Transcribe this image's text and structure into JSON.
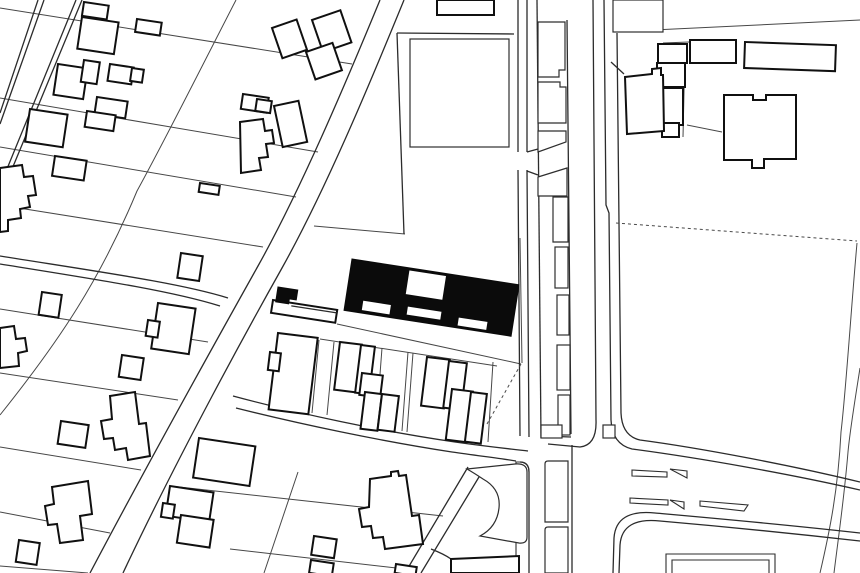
{
  "meta": {
    "description": "Black-and-white architectural figure-ground site plan with solid black building footprint at center"
  },
  "map": {
    "width": 860,
    "height": 573,
    "background": "#ffffff",
    "styles": {
      "parcel": {
        "stroke": "#474747",
        "width": 1,
        "fill": "none"
      },
      "road": {
        "stroke": "#2b2b2b",
        "width": 1.3,
        "fill": "none"
      },
      "lightline": {
        "stroke": "#2e2e2e",
        "width": 1.1,
        "fill": "none"
      },
      "light": {
        "stroke": "#2e2e2e",
        "width": 1.2,
        "fill": "#ffffff"
      },
      "building": {
        "stroke": "#101010",
        "width": 2,
        "fill": "#ffffff"
      },
      "solid": {
        "stroke": "#0b0b0b",
        "width": 1,
        "fill": "#0b0b0b"
      },
      "dashed": {
        "stroke": "#4a4a4a",
        "width": 1,
        "fill": "none",
        "dash": "3,3"
      }
    },
    "layers": [
      {
        "name": "parcel-lines",
        "style": "parcel",
        "paths": [
          "M0,8 L352,64",
          "M0,98 L318,152",
          "M0,147 L296,197",
          "M0,205 L263,247",
          "M0,309 L208,342",
          "M0,373 L178,400",
          "M0,447 L141,470",
          "M0,512 L110,533",
          "M0,566 L88,573",
          "M236,0 C200,70 165,140 137,191 C100,280 60,340 0,415",
          "M314,226 L405,234",
          "M520,238 L522,363",
          "M337,324 L521,364",
          "M320,339 L497,366",
          "M319,340 L312,413",
          "M334,342 L327,415",
          "M382,348 L376,427",
          "M408,352 L402,431",
          "M413,353 L407,432",
          "M493,362 L488,442",
          "M298,472 L264,573",
          "M170,486 L443,516",
          "M230,549 L414,570",
          "M685,45 L683,137",
          "M687,125 L722,132",
          "M663,43 L689,42",
          "M613,32 L860,20",
          "M857,243 C851,310 846,390 841,432 C838,490 830,530 820,573",
          "M860,368 C855,400 850,430 848,452 C844,500 838,540 834,573"
        ]
      },
      {
        "name": "road-lines",
        "style": "road",
        "paths": [
          "M380,0 C345,85 300,191 258,266 C225,325 155,450 90,573",
          "M404,0 C368,88 325,191 282,268 C250,325 180,452 123,573",
          "M38,0 L0,113",
          "M44,0 L0,124",
          "M76,0 L0,186",
          "M82,0 L0,198",
          "M0,256 C100,272 180,283 228,298",
          "M0,264 C100,280 172,291 220,306",
          "M518,0 L518,152 M518,170 L520,436",
          "M527,0 L527,152 M527,170 L529,437",
          "M537,0 L541,438",
          "M567,20 L571,434 M541,436 L571,437",
          "M527,152 L538,149 M527,171 L538,175",
          "M593,0 L596,420 Q597,445 580,447 L548,444",
          "M604,0 L606,205 L609,213 L611,420 Q612,444 632,449 C700,458 790,474 860,490",
          "M617,33 L621,413 Q622,436 640,440 C700,448 790,465 860,482",
          "M611,62 L624,74",
          "M860,533 C780,524 700,517 655,513 Q616,509 614,538 L613,573",
          "M860,541 C780,532 706,525 660,521 Q622,517 620,545 L619,573",
          "M233,396 C300,414 380,431 455,442 C490,447 512,449 528,451",
          "M236,408 C300,424 380,441 452,452 C480,456 505,459 516,461",
          "M520,462 Q529,462 529,472 L529,573",
          "M572,445 L572,573",
          "M397,33 L404,234",
          "M397,33 L514,34",
          "M468,467 L405,573",
          "M482,472 L421,573",
          "M431,549 Q444,554 451,559"
        ]
      },
      {
        "name": "light-open-lines",
        "style": "lightline",
        "paths": [
          "M516,573 L516,462 L519,462 Q529,462 529,472",
          "M666,573 L666,554 L775,554 L775,573",
          "M672,573 L672,560 L769,560 L769,573",
          "M632,470 L667,472 L667,477 L632,476 Z",
          "M630,498 L668,500 L668,505 L630,503 Z",
          "M670,469 L687,471 L687,478 Z",
          "M670,500 L684,502 L684,509 Z",
          "M700,501 L748,505 L744,511 L700,506 Z",
          "M466,558 L466,573 M480,558 L480,573 M494,557 L494,573 M508,557 L508,573"
        ]
      },
      {
        "name": "light-structures",
        "style": "light",
        "rects": [
          [
            555,
            247,
            13,
            41,
            0
          ],
          [
            557,
            295,
            12,
            40,
            0
          ],
          [
            557,
            345,
            13,
            45,
            0
          ],
          [
            558,
            395,
            12,
            40,
            0
          ],
          [
            613,
            0,
            50,
            32,
            0
          ],
          [
            541,
            425,
            21,
            13,
            0
          ],
          [
            603,
            425,
            12,
            13,
            0
          ],
          [
            410,
            39,
            99,
            108,
            0
          ]
        ],
        "paths": [
          "M538,22 L565,22 L565,70 L559,70 L559,77 L538,77 Z",
          "M538,82 L560,82 L560,87 L566,87 L566,123 L538,123 Z",
          "M538,131 L566,131 L566,142 L538,152 Z",
          "M538,177 L567,168 L567,196 L538,196 Z",
          "M553,197 L568,197 L568,242 L553,242 Z",
          "M548,461 L568,461 L568,522 L545,522 L545,464 Q545,461 548,461 Z",
          "M548,527 L568,527 L568,573 L545,573 L545,530 Q545,527 548,527 Z",
          "M467,469 L515,464 Q527,463 527,472 L527,537 Q527,544 519,543 L480,536 Q497,527 499,508 Q501,489 483,479 Q474,473 467,469 Z"
        ]
      },
      {
        "name": "building-outlines",
        "style": "building",
        "rects": [
          [
            84,
            2,
            25,
            14,
            8.5
          ],
          [
            82,
            17,
            37,
            32,
            8.5
          ],
          [
            137,
            19,
            25,
            13,
            8.5
          ],
          [
            58,
            64,
            30,
            31,
            8.5
          ],
          [
            84,
            60,
            16,
            22,
            8.5
          ],
          [
            110,
            64,
            24,
            17,
            8.5
          ],
          [
            132,
            68,
            12,
            13,
            8.5
          ],
          [
            97,
            97,
            31,
            17,
            8.5
          ],
          [
            87,
            111,
            29,
            16,
            8.5
          ],
          [
            30,
            109,
            38,
            33,
            8.5
          ],
          [
            55,
            156,
            32,
            20,
            8.5
          ],
          [
            181,
            253,
            22,
            25,
            8.5
          ],
          [
            42,
            292,
            20,
            23,
            8.5
          ],
          [
            158,
            303,
            38,
            46,
            8.5
          ],
          [
            148,
            320,
            12,
            16,
            8.5
          ],
          [
            122,
            355,
            22,
            22,
            8.5
          ],
          [
            61,
            421,
            28,
            23,
            8.5
          ],
          [
            19,
            540,
            21,
            22,
            8.5
          ],
          [
            199,
            438,
            57,
            40,
            8.5
          ],
          [
            170,
            486,
            44,
            30,
            8.5
          ],
          [
            181,
            515,
            33,
            28,
            8.5
          ],
          [
            163,
            503,
            12,
            14,
            8.5
          ],
          [
            200,
            183,
            20,
            9,
            8.5
          ],
          [
            243,
            94,
            26,
            15,
            8.5
          ],
          [
            257,
            99,
            15,
            12,
            8.5
          ],
          [
            272,
            28,
            26,
            32,
            -19
          ],
          [
            312,
            20,
            30,
            34,
            -19
          ],
          [
            306,
            52,
            28,
            29,
            -19
          ],
          [
            274,
            106,
            25,
            42,
            -12
          ],
          [
            278,
            333,
            40,
            77,
            7
          ],
          [
            270,
            352,
            11,
            18,
            7
          ],
          [
            340,
            342,
            22,
            48,
            7
          ],
          [
            361,
            345,
            14,
            48,
            7
          ],
          [
            362,
            373,
            21,
            22,
            7
          ],
          [
            365,
            392,
            17,
            37,
            7
          ],
          [
            382,
            394,
            17,
            36,
            7
          ],
          [
            427,
            357,
            23,
            49,
            7
          ],
          [
            449,
            361,
            18,
            47,
            7
          ],
          [
            452,
            389,
            21,
            51,
            7
          ],
          [
            471,
            392,
            16,
            50,
            7
          ],
          [
            314,
            536,
            23,
            19,
            8.5
          ],
          [
            311,
            560,
            23,
            13,
            8.5
          ],
          [
            396,
            564,
            21,
            9,
            8.5
          ],
          [
            658,
            44,
            29,
            19,
            0
          ],
          [
            657,
            63,
            28,
            24,
            0
          ],
          [
            663,
            88,
            20,
            37,
            0
          ],
          [
            662,
            123,
            17,
            14,
            0
          ],
          [
            690,
            40,
            46,
            23,
            0
          ],
          [
            745,
            42,
            91,
            26,
            2
          ],
          [
            437,
            0,
            57,
            15,
            0
          ]
        ],
        "paths": [
          "M0,168 L22,165 L24,177 L33,176 L36,195 L28,196 L30,207 L20,209 L21,218 L8,220 L8,231 L0,232 Z",
          "M0,328 L14,326 L16,339 L25,338 L27,351 L18,353 L19,366 L0,368 Z",
          "M240,122 L263,119 L265,131 L272,130 L274,143 L266,144 L268,157 L259,158 L261,170 L241,173 Z",
          "M110,396 L135,392 L139,424 L146,423 L150,456 L128,460 L126,448 L115,450 L113,438 L104,439 L101,421 L112,419 Z",
          "M52,487 L88,481 L92,514 L80,516 L83,540 L60,543 L57,524 L48,525 L45,506 L54,504 Z",
          "M370,479 L391,476 L391,472 L398,471 L399,476 L406,475 L412,516 L419,515 L423,544 L385,549 L383,537 L373,538 L371,526 L362,527 L359,509 L369,507 Z",
          "M625,77 L652,74 L652,69 L661,68 L661,75 L663,75 L664,131 L627,134 Z",
          "M724,95 L753,95 L753,100 L766,100 L766,95 L796,95 L796,159 L764,159 L764,168 L752,168 L752,160 L724,160 Z",
          "M451,559 L519,556 L519,573 L451,573 Z",
          {
            "d": "M273,300 L338,300 L338,313 L273,313 Z",
            "t": "rotate(8.8 273 300)"
          }
        ]
      },
      {
        "name": "building-footprints-solid",
        "style": "solid",
        "paths": [
          {
            "d": "M352,259 L521,259 L521,311 L352,311 Z M410,261 L448,261 L448,286 L410,286 Z M369,298 L398,298 L398,308.5 L369,308.5 Z M414,297 L449,297 L449,306 L414,306 Z M466,300 L496,300 L496,309 L466,309 Z",
            "t": "rotate(8.8 352 259)"
          },
          {
            "d": "M278,287 L298,287 L298,297 L291,297 L291,302 L278,302 Z",
            "t": "rotate(8.8 278 287)"
          }
        ]
      },
      {
        "name": "overlay-lines",
        "style": "road",
        "paths": [
          {
            "d": "M292,303 L338,303",
            "t": "rotate(8.8 273 300)"
          }
        ]
      },
      {
        "name": "dashed-boundaries",
        "style": "dashed",
        "paths": [
          "M616,223 L857,241",
          "M521,364 L487,424"
        ]
      }
    ]
  }
}
